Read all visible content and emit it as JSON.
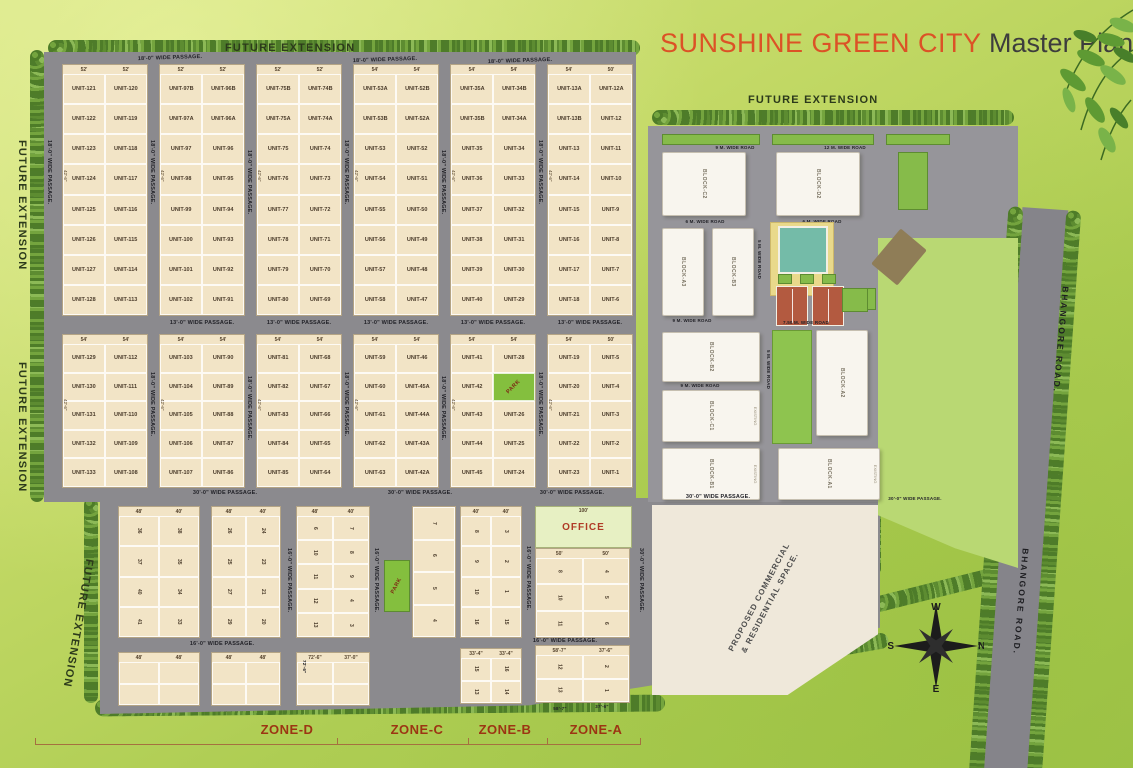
{
  "title": {
    "brand": "SUNSHINE GREEN CITY",
    "suffix": " Master Plan"
  },
  "future_extension": "FUTURE EXTENSION",
  "zones": [
    "ZONE-D",
    "ZONE-C",
    "ZONE-B",
    "ZONE-A"
  ],
  "compass": {
    "w": "W",
    "n": "N",
    "s": "S",
    "e": "E"
  },
  "bhangore_road": "BHANGORE ROAD.",
  "passages": {
    "p18": "18'-0\" WIDE PASSAGE.",
    "p13": "13'-0\" WIDE PASSAGE.",
    "p30": "30'-0\" WIDE PASSAGE.",
    "p16": "16'-0\" WIDE PASSAGE."
  },
  "roads": {
    "r12": "12 M. WIDE ROAD",
    "r9": "9 M. WIDE ROAD",
    "r6": "6 M. WIDE ROAD",
    "r5": "5 M. WIDE ROAD",
    "r750": "7.50 M. WIDE ROAD"
  },
  "office": {
    "label": "OFFICE",
    "dim": "100'"
  },
  "park_label": "PARK",
  "commercial": {
    "line1": "PROPOSED COMMERCIAL",
    "line2": "& RESIDENTIAL SPACE."
  },
  "colors": {
    "brand_orange": "#dc5226",
    "plot_cream": "#f2e4c6",
    "park_green": "#84bf3e",
    "road_gray": "#8b8a8e"
  },
  "top_section": {
    "blocks": [
      {
        "dims_top": [
          "52'",
          "52'"
        ],
        "side_dim": "42'-6\"",
        "rows": [
          [
            "UNIT-121",
            "UNIT-120"
          ],
          [
            "UNIT-122",
            "UNIT-119"
          ],
          [
            "UNIT-123",
            "UNIT-118"
          ],
          [
            "UNIT-124",
            "UNIT-117"
          ],
          [
            "UNIT-125",
            "UNIT-116"
          ],
          [
            "UNIT-126",
            "UNIT-115"
          ],
          [
            "UNIT-127",
            "UNIT-114"
          ],
          [
            "UNIT-128",
            "UNIT-113"
          ]
        ]
      },
      {
        "dims_top": [
          "52'",
          "52'"
        ],
        "side_dim": "42'-6\"",
        "rows": [
          [
            "UNIT-97B",
            "UNIT-96B"
          ],
          [
            "UNIT-97A",
            "UNIT-96A"
          ],
          [
            "UNIT-97",
            "UNIT-96"
          ],
          [
            "UNIT-98",
            "UNIT-95"
          ],
          [
            "UNIT-99",
            "UNIT-94"
          ],
          [
            "UNIT-100",
            "UNIT-93"
          ],
          [
            "UNIT-101",
            "UNIT-92"
          ],
          [
            "UNIT-102",
            "UNIT-91"
          ]
        ]
      },
      {
        "dims_top": [
          "52'",
          "52'"
        ],
        "side_dim": "42'-6\"",
        "rows": [
          [
            "UNIT-75B",
            "UNIT-74B"
          ],
          [
            "UNIT-75A",
            "UNIT-74A"
          ],
          [
            "UNIT-75",
            "UNIT-74"
          ],
          [
            "UNIT-76",
            "UNIT-73"
          ],
          [
            "UNIT-77",
            "UNIT-72"
          ],
          [
            "UNIT-78",
            "UNIT-71"
          ],
          [
            "UNIT-79",
            "UNIT-70"
          ],
          [
            "UNIT-80",
            "UNIT-69"
          ]
        ]
      },
      {
        "dims_top": [
          "54'",
          "54'"
        ],
        "side_dim": "42'-6\"",
        "rows": [
          [
            "UNIT-53A",
            "UNIT-52B"
          ],
          [
            "UNIT-53B",
            "UNIT-52A"
          ],
          [
            "UNIT-53",
            "UNIT-52"
          ],
          [
            "UNIT-54",
            "UNIT-51"
          ],
          [
            "UNIT-55",
            "UNIT-50"
          ],
          [
            "UNIT-56",
            "UNIT-49"
          ],
          [
            "UNIT-57",
            "UNIT-48"
          ],
          [
            "UNIT-58",
            "UNIT-47"
          ]
        ]
      },
      {
        "dims_top": [
          "54'",
          "54'"
        ],
        "side_dim": "42'-6\"",
        "rows": [
          [
            "UNIT-35A",
            "UNIT-34B"
          ],
          [
            "UNIT-35B",
            "UNIT-34A"
          ],
          [
            "UNIT-35",
            "UNIT-34"
          ],
          [
            "UNIT-36",
            "UNIT-33"
          ],
          [
            "UNIT-37",
            "UNIT-32"
          ],
          [
            "UNIT-38",
            "UNIT-31"
          ],
          [
            "UNIT-39",
            "UNIT-30"
          ],
          [
            "UNIT-40",
            "UNIT-29"
          ]
        ]
      },
      {
        "dims_top": [
          "54'",
          "50'"
        ],
        "side_dim": "42'-6\"",
        "rows": [
          [
            "UNIT-13A",
            "UNIT-12A"
          ],
          [
            "UNIT-13B",
            "UNIT-12"
          ],
          [
            "UNIT-13",
            "UNIT-11"
          ],
          [
            "UNIT-14",
            "UNIT-10"
          ],
          [
            "UNIT-15",
            "UNIT-9"
          ],
          [
            "UNIT-16",
            "UNIT-8"
          ],
          [
            "UNIT-17",
            "UNIT-7"
          ],
          [
            "UNIT-18",
            "UNIT-6"
          ]
        ]
      }
    ]
  },
  "middle_section": {
    "blocks": [
      {
        "dims_top": [
          "54'",
          "54'"
        ],
        "side_dim": "42'-6\"",
        "rows": [
          [
            "UNIT-129",
            "UNIT-112"
          ],
          [
            "UNIT-130",
            "UNIT-111"
          ],
          [
            "UNIT-131",
            "UNIT-110"
          ],
          [
            "UNIT-132",
            "UNIT-109"
          ],
          [
            "UNIT-133",
            "UNIT-108"
          ]
        ]
      },
      {
        "dims_top": [
          "54'",
          "54'"
        ],
        "side_dim": "42'-6\"",
        "rows": [
          [
            "UNIT-103",
            "UNIT-90"
          ],
          [
            "UNIT-104",
            "UNIT-89"
          ],
          [
            "UNIT-105",
            "UNIT-88"
          ],
          [
            "UNIT-106",
            "UNIT-87"
          ],
          [
            "UNIT-107",
            "UNIT-86"
          ]
        ]
      },
      {
        "dims_top": [
          "54'",
          "54'"
        ],
        "side_dim": "42'-6\"",
        "rows": [
          [
            "UNIT-81",
            "UNIT-68"
          ],
          [
            "UNIT-82",
            "UNIT-67"
          ],
          [
            "UNIT-83",
            "UNIT-66"
          ],
          [
            "UNIT-84",
            "UNIT-65"
          ],
          [
            "UNIT-85",
            "UNIT-64"
          ]
        ]
      },
      {
        "dims_top": [
          "54'",
          "54'"
        ],
        "side_dim": "42'-6\"",
        "rows": [
          [
            "UNIT-59",
            "UNIT-46"
          ],
          [
            "UNIT-60",
            "UNIT-45A"
          ],
          [
            "UNIT-61",
            "UNIT-44A"
          ],
          [
            "UNIT-62",
            "UNIT-43A"
          ],
          [
            "UNIT-63",
            "UNIT-42A"
          ]
        ]
      },
      {
        "dims_top": [
          "54'",
          "54'"
        ],
        "side_dim": "42'-6\"",
        "rows": [
          [
            "UNIT-41",
            "UNIT-28"
          ],
          [
            "UNIT-42",
            "PARK"
          ],
          [
            "UNIT-43",
            "UNIT-26"
          ],
          [
            "UNIT-44",
            "UNIT-25"
          ],
          [
            "UNIT-45",
            "UNIT-24"
          ]
        ]
      },
      {
        "dims_top": [
          "54'",
          "50'"
        ],
        "side_dim": "42'-6\"",
        "rows": [
          [
            "UNIT-19",
            "UNIT-5"
          ],
          [
            "UNIT-20",
            "UNIT-4"
          ],
          [
            "UNIT-21",
            "UNIT-3"
          ],
          [
            "UNIT-22",
            "UNIT-2"
          ],
          [
            "UNIT-23",
            "UNIT-1"
          ]
        ]
      }
    ]
  },
  "bottom_section": {
    "dims": [
      "72'-6\"",
      "58'-7\"",
      "37'-6\"",
      "33'-4\"",
      "48'",
      "50'"
    ],
    "blocks": [
      {
        "dims_top": [
          "48'",
          "40'"
        ],
        "rotate_cells": true,
        "rows": [
          [
            "36",
            "38"
          ],
          [
            "37",
            "35"
          ],
          [
            "40",
            "34"
          ],
          [
            "41",
            "33"
          ]
        ]
      },
      {
        "dims_top": [
          "48'",
          "40'"
        ],
        "rotate_cells": true,
        "rows": [
          [
            "26",
            "24"
          ],
          [
            "25",
            "23"
          ],
          [
            "27",
            "21"
          ],
          [
            "29",
            "20"
          ]
        ]
      },
      {
        "dims_top": [
          "48'",
          "40'"
        ],
        "rotate_cells": true,
        "rows": [
          [
            "6",
            "7"
          ],
          [
            "10",
            "8"
          ],
          [
            "11",
            "9"
          ],
          [
            "12",
            "4"
          ],
          [
            "13",
            "3"
          ]
        ]
      },
      {
        "rotate_cells": true,
        "rows": [
          [
            "7"
          ],
          [
            "6"
          ],
          [
            "5"
          ],
          [
            "4"
          ]
        ]
      },
      {
        "dims_top": [
          "40'",
          "40'"
        ],
        "rotate_cells": true,
        "rows": [
          [
            "8",
            "3"
          ],
          [
            "9",
            "2"
          ],
          [
            "10",
            "1"
          ],
          [
            "16",
            "15"
          ]
        ]
      },
      {
        "dims_top": [
          "50'",
          "50'"
        ],
        "rotate_cells": true,
        "rows": [
          [
            "8",
            "4"
          ],
          [
            "10",
            "5"
          ],
          [
            "11",
            "6"
          ]
        ]
      },
      {
        "dims_top": [
          "48'",
          "48'"
        ],
        "rotate_cells": true,
        "rows": [
          [
            "",
            ""
          ],
          [
            "",
            ""
          ]
        ]
      },
      {
        "dims_top": [
          "48'",
          "48'"
        ],
        "rotate_cells": true,
        "rows": [
          [
            "",
            ""
          ],
          [
            "",
            ""
          ]
        ]
      },
      {
        "dims_top": [
          "72'-6\"",
          "37'-0\""
        ],
        "rotate_cells": true,
        "rows": [
          [
            "",
            ""
          ],
          [
            "",
            ""
          ]
        ]
      },
      {
        "dims_top": [
          "33'-4\"",
          "33'-4\""
        ],
        "rotate_cells": true,
        "rows": [
          [
            "15",
            "16"
          ],
          [
            "13",
            "14"
          ]
        ]
      },
      {
        "dims_top": [
          "58'-7\"",
          "37'-6\""
        ],
        "rotate_cells": true,
        "rows": [
          [
            "12",
            "2"
          ],
          [
            "13",
            "1"
          ]
        ]
      }
    ]
  },
  "right_complex": {
    "blocks": [
      "BLOCK-C2",
      "BLOCK-D2",
      "BLOCK-A3",
      "BLOCK-B3",
      "BLOCK-B2",
      "BLOCK-A2",
      "BLOCK-C1",
      "BLOCK-B1",
      "BLOCK-A1"
    ],
    "existing": "EXISTING"
  }
}
